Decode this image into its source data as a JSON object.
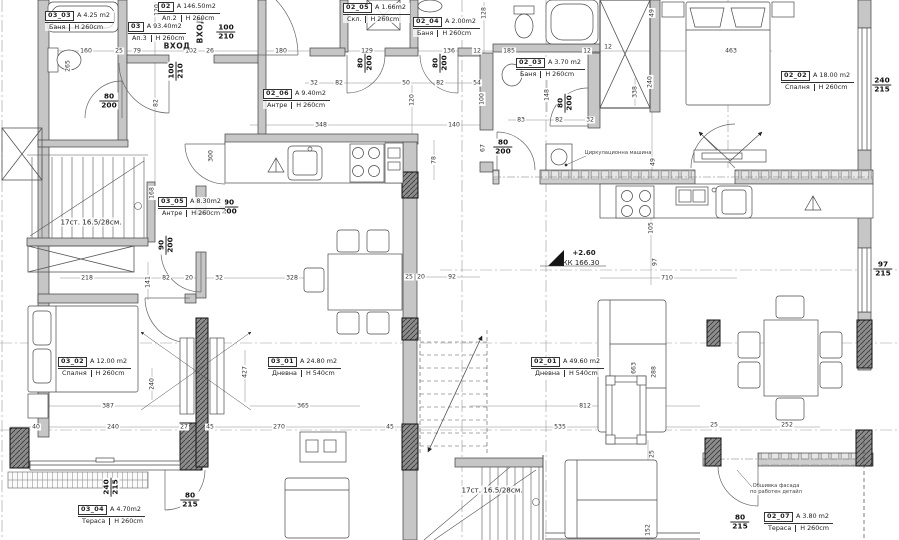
{
  "colors": {
    "wall_fill": "#c6c6c6",
    "masonry_fill": "#cdcdcd",
    "column_fill": "#8d8d8d",
    "line": "#3f3f3f",
    "paper": "#ffffff"
  },
  "apartments": [
    {
      "id": "02",
      "area": "A 146.50m2",
      "name": "Ап.2",
      "height": "H 260cm",
      "x": 158,
      "y": 2
    },
    {
      "id": "03",
      "area": "A 93.40m2",
      "name": "Ап.3",
      "height": "H 260cm",
      "x": 128,
      "y": 22
    }
  ],
  "rooms": [
    {
      "id": "03_03",
      "area": "A 4.25 m2",
      "name": "Баня",
      "height": "H 260cm",
      "x": 45,
      "y": 11
    },
    {
      "id": "02_05",
      "area": "A 1.66m2",
      "name": "Скл.",
      "height": "H 260cm",
      "x": 343,
      "y": 3
    },
    {
      "id": "02_04",
      "area": "A 2.00m2",
      "name": "Баня",
      "height": "H 260cm",
      "x": 413,
      "y": 17
    },
    {
      "id": "02_03",
      "area": "A 3.70 m2",
      "name": "Баня",
      "height": "H 260cm",
      "x": 516,
      "y": 58
    },
    {
      "id": "02_02",
      "area": "A 18.00 m2",
      "name": "Спалня",
      "height": "H 260cm",
      "x": 781,
      "y": 71
    },
    {
      "id": "02_06",
      "area": "A 9.40m2",
      "name": "Антре",
      "height": "H 260cm",
      "x": 263,
      "y": 89
    },
    {
      "id": "03_05",
      "area": "A 8.30m2",
      "name": "Антре",
      "height": "H 260cm",
      "x": 158,
      "y": 197
    },
    {
      "id": "03_02",
      "area": "A 12.00 m2",
      "name": "Спалня",
      "height": "H 260cm",
      "x": 58,
      "y": 357
    },
    {
      "id": "03_01",
      "area": "A 24.80 m2",
      "name": "Дневна",
      "height": "H 540cm",
      "x": 268,
      "y": 357
    },
    {
      "id": "02_01",
      "area": "A 49.60 m2",
      "name": "Дневна",
      "height": "H 540cm",
      "x": 531,
      "y": 357
    },
    {
      "id": "03_04",
      "area": "A 4.70m2",
      "name": "Тераса",
      "height": "H 260cm",
      "x": 78,
      "y": 505
    },
    {
      "id": "02_07",
      "area": "A 3.80 m2",
      "name": "Тераса",
      "height": "H 260cm",
      "x": 764,
      "y": 512
    }
  ],
  "door_sizes": [
    {
      "w": "100",
      "h": "210",
      "x": 226,
      "y": 32,
      "r": 0
    },
    {
      "w": "100",
      "h": "210",
      "x": 176,
      "y": 71,
      "r": 1
    },
    {
      "w": "80",
      "h": "200",
      "x": 109,
      "y": 101,
      "r": 0
    },
    {
      "w": "80",
      "h": "200",
      "x": 365,
      "y": 63,
      "r": 1
    },
    {
      "w": "80",
      "h": "200",
      "x": 440,
      "y": 63,
      "r": 1
    },
    {
      "w": "80",
      "h": "200",
      "x": 565,
      "y": 103,
      "r": 1
    },
    {
      "w": "80",
      "h": "200",
      "x": 503,
      "y": 147,
      "r": 0
    },
    {
      "w": "90",
      "h": "200",
      "x": 229,
      "y": 207,
      "r": 0
    },
    {
      "w": "90",
      "h": "200",
      "x": 166,
      "y": 245,
      "r": 1
    },
    {
      "w": "240",
      "h": "215",
      "x": 882,
      "y": 85,
      "r": 0
    },
    {
      "w": "97",
      "h": "215",
      "x": 883,
      "y": 269,
      "r": 0
    },
    {
      "w": "240",
      "h": "215",
      "x": 111,
      "y": 487,
      "r": 1
    },
    {
      "w": "80",
      "h": "215",
      "x": 190,
      "y": 500,
      "r": 0
    },
    {
      "w": "80",
      "h": "215",
      "x": 740,
      "y": 522,
      "r": 0
    }
  ],
  "dimensions": [
    {
      "t": "160",
      "x": 86,
      "y": 51,
      "r": 0
    },
    {
      "t": "25",
      "x": 119,
      "y": 51,
      "r": 0
    },
    {
      "t": "79",
      "x": 137,
      "y": 51,
      "r": 0
    },
    {
      "t": "102",
      "x": 191,
      "y": 51,
      "r": 0
    },
    {
      "t": "26",
      "x": 210,
      "y": 51,
      "r": 0
    },
    {
      "t": "180",
      "x": 281,
      "y": 51,
      "r": 0
    },
    {
      "t": "129",
      "x": 367,
      "y": 51,
      "r": 0
    },
    {
      "t": "136",
      "x": 449,
      "y": 51,
      "r": 0
    },
    {
      "t": "12",
      "x": 477,
      "y": 51,
      "r": 0
    },
    {
      "t": "185",
      "x": 509,
      "y": 51,
      "r": 0
    },
    {
      "t": "12",
      "x": 587,
      "y": 51,
      "r": 0
    },
    {
      "t": "12",
      "x": 608,
      "y": 47,
      "r": 0
    },
    {
      "t": "463",
      "x": 731,
      "y": 51,
      "r": 0
    },
    {
      "t": "32",
      "x": 314,
      "y": 83,
      "r": 0
    },
    {
      "t": "82",
      "x": 339,
      "y": 83,
      "r": 0
    },
    {
      "t": "50",
      "x": 406,
      "y": 83,
      "r": 0
    },
    {
      "t": "82",
      "x": 440,
      "y": 83,
      "r": 0
    },
    {
      "t": "54",
      "x": 477,
      "y": 83,
      "r": 0
    },
    {
      "t": "83",
      "x": 521,
      "y": 120,
      "r": 0
    },
    {
      "t": "82",
      "x": 559,
      "y": 120,
      "r": 0
    },
    {
      "t": "32",
      "x": 590,
      "y": 120,
      "r": 0
    },
    {
      "t": "348",
      "x": 321,
      "y": 125,
      "r": 0
    },
    {
      "t": "140",
      "x": 454,
      "y": 125,
      "r": 0
    },
    {
      "t": "218",
      "x": 87,
      "y": 278,
      "r": 0
    },
    {
      "t": "82",
      "x": 166,
      "y": 278,
      "r": 0
    },
    {
      "t": "20",
      "x": 189,
      "y": 278,
      "r": 0
    },
    {
      "t": "32",
      "x": 219,
      "y": 278,
      "r": 0
    },
    {
      "t": "328",
      "x": 292,
      "y": 278,
      "r": 0
    },
    {
      "t": "25",
      "x": 409,
      "y": 277,
      "r": 0
    },
    {
      "t": "20",
      "x": 421,
      "y": 277,
      "r": 0
    },
    {
      "t": "92",
      "x": 452,
      "y": 277,
      "r": 0
    },
    {
      "t": "710",
      "x": 667,
      "y": 278,
      "r": 0
    },
    {
      "t": "387",
      "x": 108,
      "y": 406,
      "r": 0
    },
    {
      "t": "365",
      "x": 303,
      "y": 406,
      "r": 0
    },
    {
      "t": "812",
      "x": 585,
      "y": 406,
      "r": 0
    },
    {
      "t": "40",
      "x": 36,
      "y": 427,
      "r": 0
    },
    {
      "t": "240",
      "x": 113,
      "y": 427,
      "r": 0
    },
    {
      "t": "27",
      "x": 184,
      "y": 427,
      "r": 0
    },
    {
      "t": "45",
      "x": 210,
      "y": 427,
      "r": 0
    },
    {
      "t": "270",
      "x": 279,
      "y": 427,
      "r": 0
    },
    {
      "t": "45",
      "x": 390,
      "y": 427,
      "r": 0
    },
    {
      "t": "535",
      "x": 560,
      "y": 427,
      "r": 0
    },
    {
      "t": "25",
      "x": 714,
      "y": 425,
      "r": 0
    },
    {
      "t": "252",
      "x": 787,
      "y": 425,
      "r": 0
    },
    {
      "t": "120",
      "x": 157,
      "y": 10,
      "r": 1
    },
    {
      "t": "265",
      "x": 68,
      "y": 66,
      "r": 1
    },
    {
      "t": "82",
      "x": 156,
      "y": 103,
      "r": 1
    },
    {
      "t": "300",
      "x": 211,
      "y": 156,
      "r": 1
    },
    {
      "t": "168",
      "x": 152,
      "y": 193,
      "r": 1
    },
    {
      "t": "128",
      "x": 484,
      "y": 13,
      "r": 1
    },
    {
      "t": "100",
      "x": 482,
      "y": 99,
      "r": 1
    },
    {
      "t": "148",
      "x": 547,
      "y": 95,
      "r": 1
    },
    {
      "t": "49",
      "x": 652,
      "y": 13,
      "r": 1
    },
    {
      "t": "240",
      "x": 650,
      "y": 82,
      "r": 1
    },
    {
      "t": "338",
      "x": 635,
      "y": 92,
      "r": 1
    },
    {
      "t": "120",
      "x": 412,
      "y": 100,
      "r": 1
    },
    {
      "t": "78",
      "x": 434,
      "y": 160,
      "r": 1
    },
    {
      "t": "67",
      "x": 483,
      "y": 148,
      "r": 1
    },
    {
      "t": "49",
      "x": 653,
      "y": 162,
      "r": 1
    },
    {
      "t": "105",
      "x": 651,
      "y": 228,
      "r": 1
    },
    {
      "t": "97",
      "x": 655,
      "y": 262,
      "r": 1
    },
    {
      "t": "663",
      "x": 634,
      "y": 368,
      "r": 1
    },
    {
      "t": "288",
      "x": 654,
      "y": 372,
      "r": 1
    },
    {
      "t": "427",
      "x": 245,
      "y": 372,
      "r": 1
    },
    {
      "t": "240",
      "x": 152,
      "y": 384,
      "r": 1
    },
    {
      "t": "141",
      "x": 148,
      "y": 282,
      "r": 1
    },
    {
      "t": "25",
      "x": 652,
      "y": 454,
      "r": 1
    },
    {
      "t": "152",
      "x": 648,
      "y": 530,
      "r": 1
    }
  ],
  "annotations": [
    {
      "t": "ВХОД",
      "x": 177,
      "y": 46,
      "r": 0,
      "cls": "entr"
    },
    {
      "t": "ВХОД",
      "x": 200,
      "y": 30,
      "r": 1,
      "cls": "entr"
    },
    {
      "t": "17ст. 16.5/28см.",
      "x": 91,
      "y": 222,
      "r": 0,
      "cls": ""
    },
    {
      "t": "17ст. 16.5/28см.",
      "x": 492,
      "y": 490,
      "r": 0,
      "cls": ""
    },
    {
      "t": "Циркулационна машина",
      "x": 618,
      "y": 153,
      "r": 0,
      "cls": "small"
    },
    {
      "t": "Обшивка фасада",
      "x": 776,
      "y": 486,
      "r": 0,
      "cls": "small"
    },
    {
      "t": "по работен детайл",
      "x": 776,
      "y": 492,
      "r": 0,
      "cls": "small"
    }
  ],
  "level": {
    "value": "+2.60",
    "datum": "КК 166.30"
  }
}
